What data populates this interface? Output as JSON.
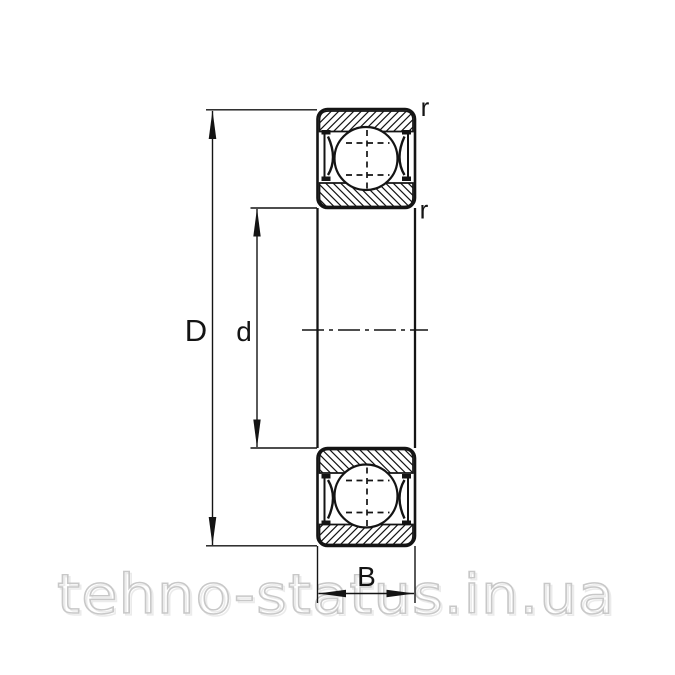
{
  "diagram": {
    "type": "ball-bearing-cross-section",
    "line_color": "#141414",
    "labels": {
      "outer_diameter": "D",
      "bore_diameter": "d",
      "width": "B",
      "chamfer_top": "r",
      "chamfer_bottom": "r"
    }
  },
  "watermark": {
    "text": "tehno-status.in.ua",
    "color": "#c8c8c8",
    "shadow_color": "#ebebeb"
  }
}
